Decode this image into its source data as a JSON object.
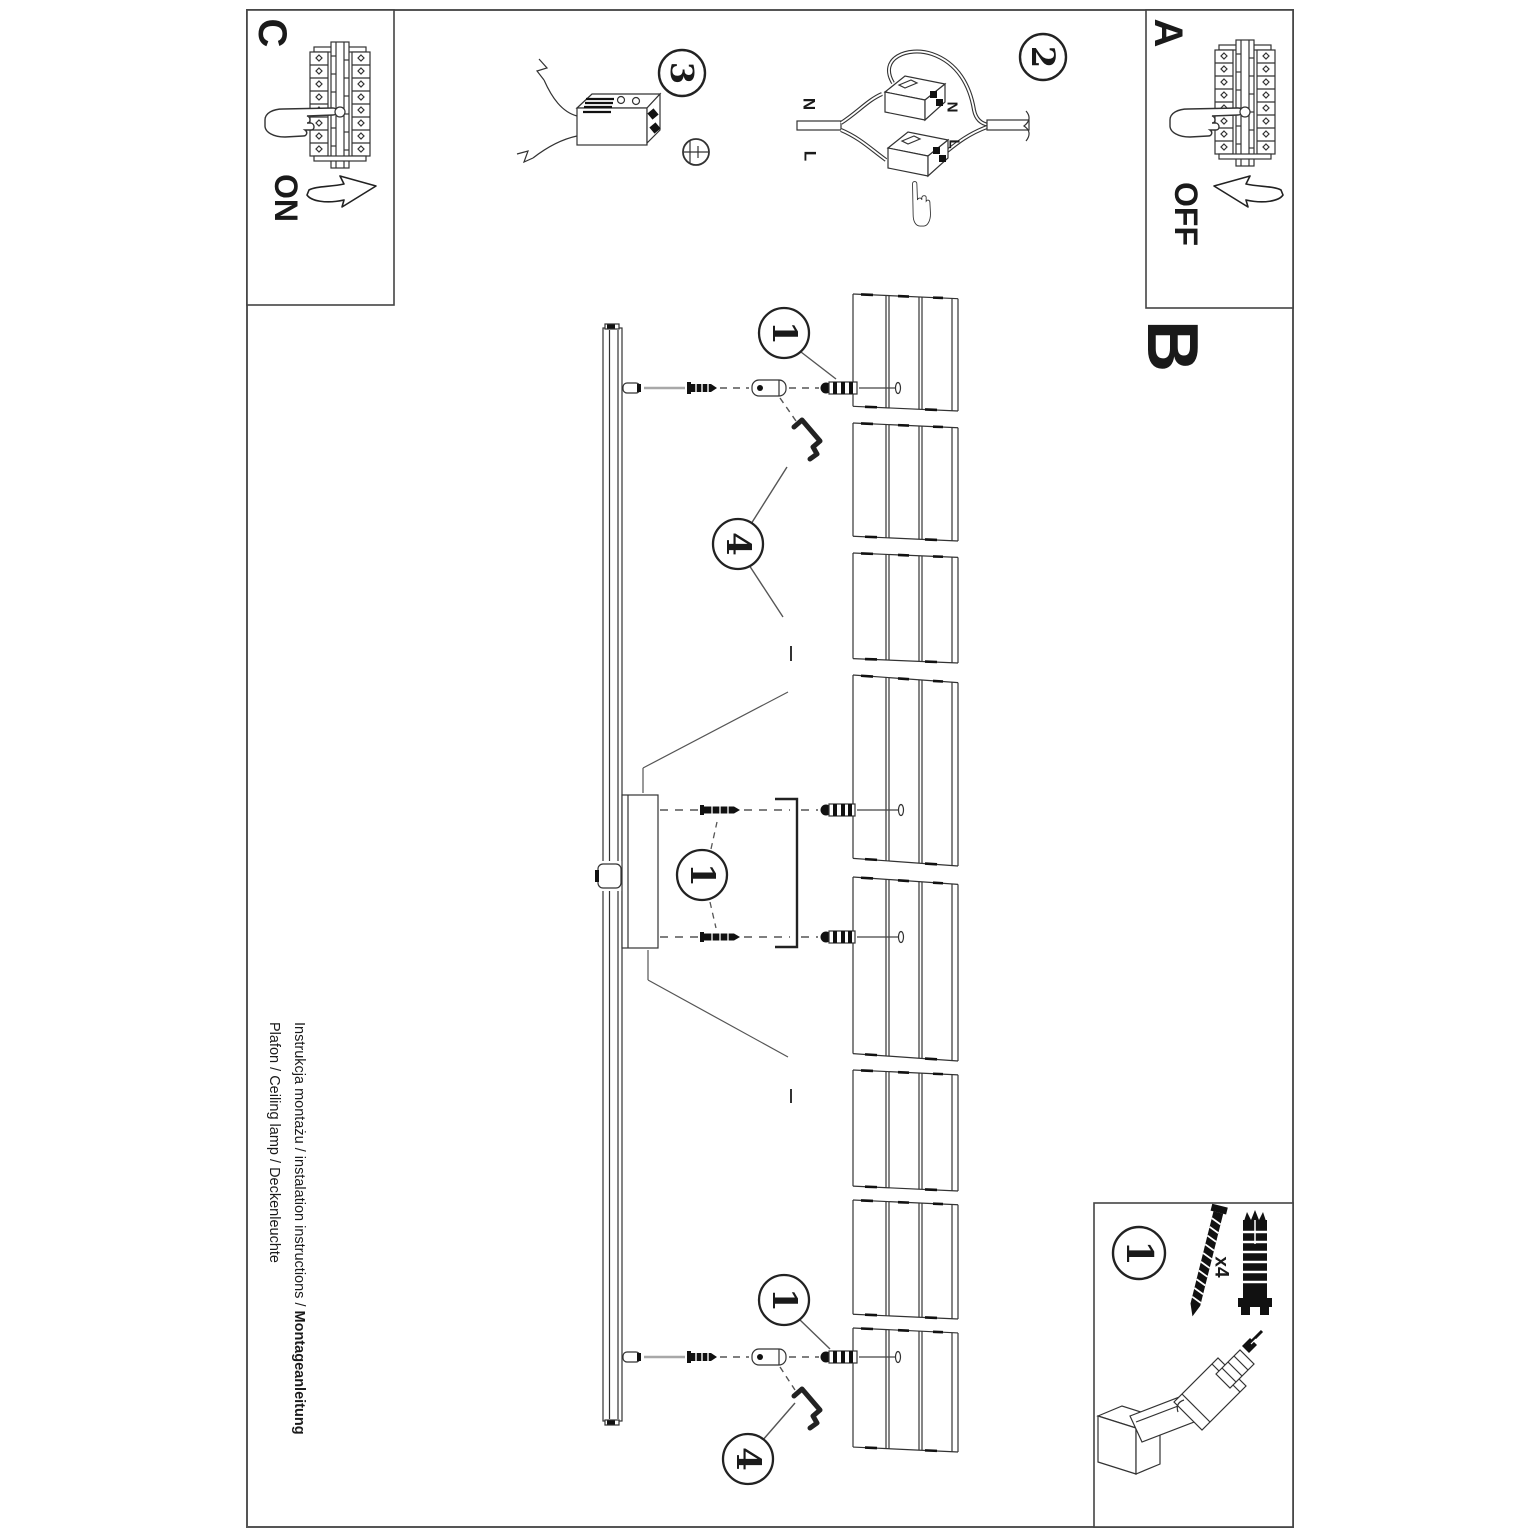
{
  "panels": {
    "power_off": {
      "letter": "A",
      "state": "OFF"
    },
    "section_b": {
      "letter": "B"
    },
    "power_on": {
      "letter": "C",
      "state": "ON"
    },
    "parts": {
      "step": "1",
      "qty": "x4"
    }
  },
  "steps": {
    "wiring": "2",
    "connector": "3"
  },
  "callouts": {
    "screw": "1",
    "hexkey": "4"
  },
  "wire_labels": {
    "n": "N",
    "l": "L"
  },
  "footer": {
    "line1": "Instrukcja montażu / instalation instructions / ",
    "line1_bold": "Montageanleitung",
    "line2": "Plafon / Ceiling lamp / Deckenleuchte"
  }
}
